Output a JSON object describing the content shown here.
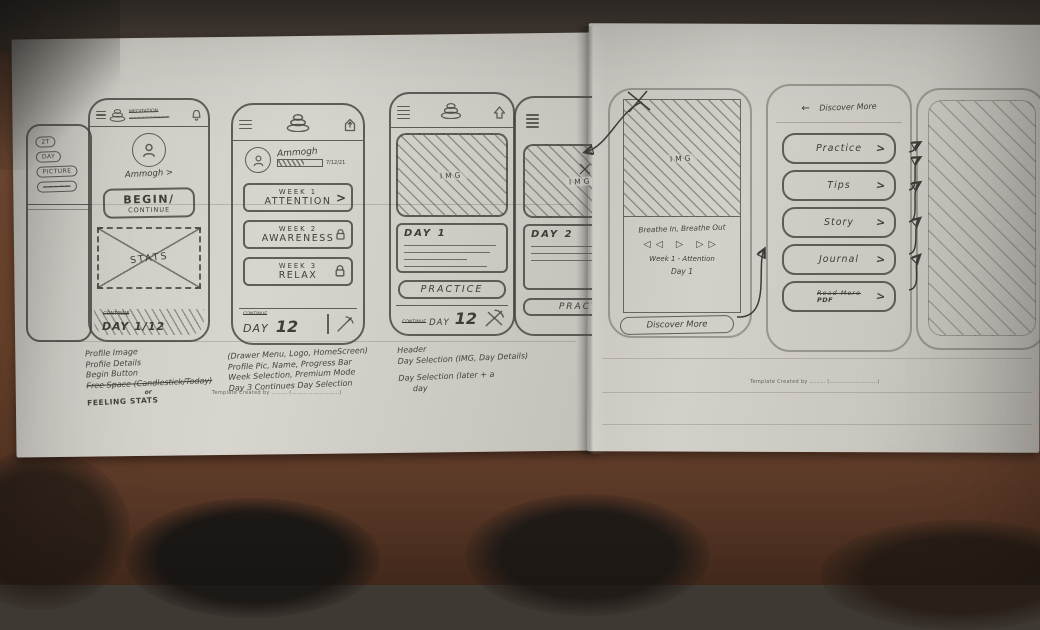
{
  "scene": {
    "description": "Photo of hand-drawn mobile-app wireframe sketches on two sheets of paper lying on a brown table",
    "ink_color": "#403d38",
    "paper_color": "#cfccc6",
    "table_color": "#74492f"
  },
  "edge_phone": {
    "chip1": "2T",
    "chip2": "DAY",
    "chip3": "PICTURE",
    "chip4": "~~~~~"
  },
  "phone_home": {
    "title_line1": "MEDITATION",
    "title_line2": "~~~~~~~~~~",
    "profile_name": "Ammogh >",
    "begin_line1": "BEGIN/",
    "begin_line2": "CONTINUE",
    "stats_label": "STATS",
    "footer_small": "CONTINUE",
    "footer_big": "DAY 1/12"
  },
  "phone_weeks": {
    "profile_name": "Ammogh",
    "progress_text": "7/12/21",
    "chevron": ">",
    "weeks": [
      {
        "week": "WEEK 1",
        "name": "ATTENTION"
      },
      {
        "week": "WEEK 2",
        "name": "AWARENESS"
      },
      {
        "week": "WEEK 3",
        "name": "RELAX"
      }
    ],
    "footer_small": "CONTINUE",
    "footer_day": "DAY",
    "footer_num": "12"
  },
  "phone_days": {
    "img_label": "IMG",
    "card_title": "DAY 1",
    "practice_label": "PRACTICE",
    "footer_small": "CONTINUE",
    "footer_day": "DAY",
    "footer_num": "12"
  },
  "phone_days_next": {
    "img_label": "IMG",
    "card_title": "DAY 2",
    "practice_label": "PRACTI"
  },
  "phone_player": {
    "img_label": "IMG",
    "track_title": "Breathe In, Breathe Out",
    "ctrl_prev": "◁◁",
    "ctrl_play": "▷",
    "ctrl_next": "▷▷",
    "week_line": "Week 1 - Attention",
    "day_line": "Day 1",
    "discover_label": "Discover More"
  },
  "phone_discover": {
    "back_arrow": "←",
    "header": "Discover More",
    "chevron": ">",
    "buttons": [
      {
        "label": "Practice"
      },
      {
        "label": "Tips"
      },
      {
        "label": "Story"
      },
      {
        "label": "Journal"
      },
      {
        "label": "Read More",
        "sublabel": "PDF"
      }
    ]
  },
  "notes_home": {
    "l1": "Profile Image",
    "l2": "Profile Details",
    "l3": "Begin Button",
    "l4": "Free Space (Candlestick/Today)",
    "l5": "or",
    "l6": "FEELING STATS"
  },
  "notes_weeks": {
    "l1": "(Drawer Menu, Logo, HomeScreen)",
    "l2": "Profile Pic, Name, Progress Bar",
    "l3": "Week Selection, Premium Mode",
    "l4": "Day 3 Continues Day Selection"
  },
  "notes_days": {
    "l1": "Header",
    "l2": "Day Selection (IMG, Day Details)",
    "l3": "Day Selection (later + a",
    "l4": "day"
  },
  "watermark": {
    "left": "Template Created by ……… (………………………)",
    "right": "Template Created by ……… (………………………)"
  }
}
